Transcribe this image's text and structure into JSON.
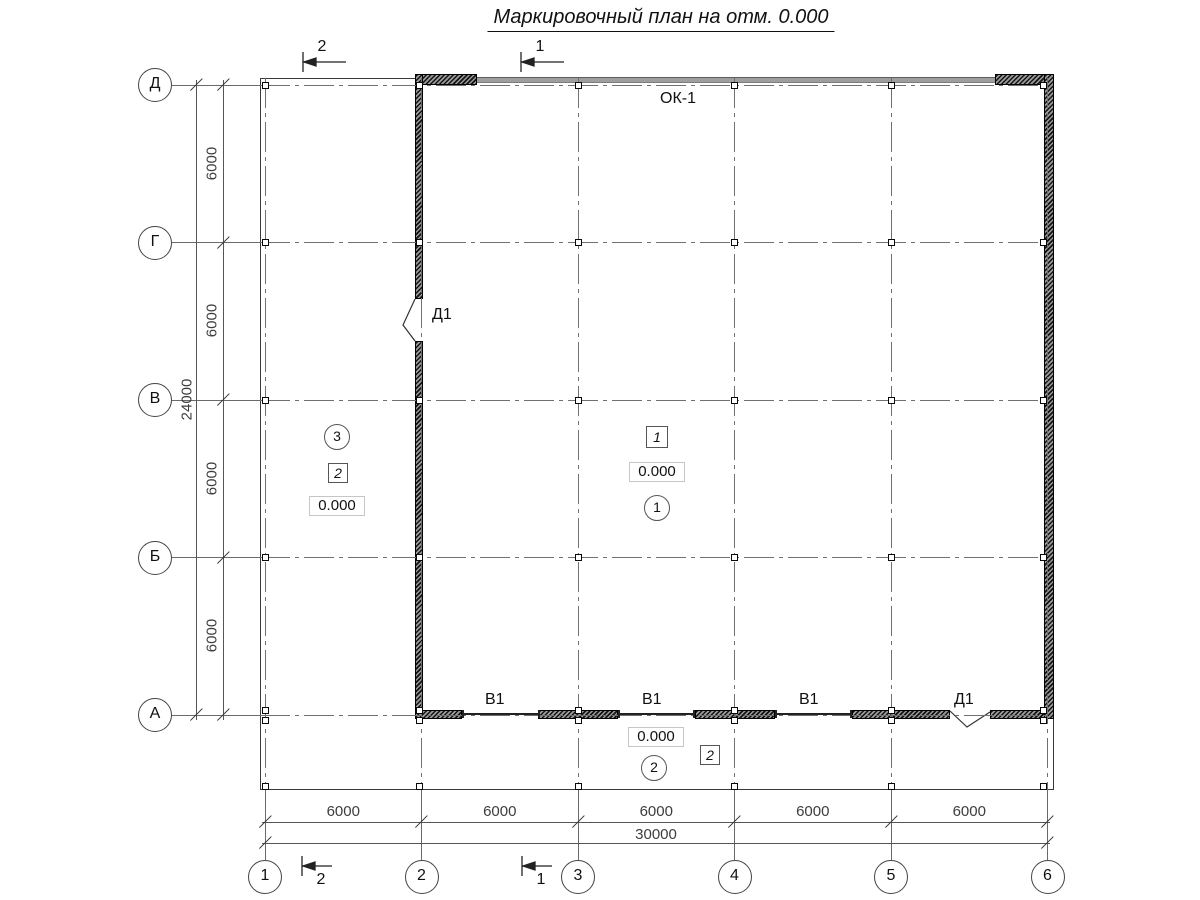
{
  "title": "Маркировочный план на отм. 0.000",
  "axes": {
    "rows": [
      "Д",
      "Г",
      "В",
      "Б",
      "А"
    ],
    "cols": [
      "1",
      "2",
      "3",
      "4",
      "5",
      "6"
    ]
  },
  "dims": {
    "row_segments": [
      "6000",
      "6000",
      "6000",
      "6000"
    ],
    "row_total": "24000",
    "col_segments": [
      "6000",
      "6000",
      "6000",
      "6000",
      "6000"
    ],
    "col_total": "30000"
  },
  "sections": {
    "top": [
      "2",
      "1"
    ],
    "bottom": [
      "2",
      "1"
    ]
  },
  "marks": {
    "window": "ОК-1",
    "door_left": "Д1",
    "door_bottom": "Д1",
    "gates": [
      "В1",
      "В1",
      "В1"
    ]
  },
  "rooms": {
    "hall": {
      "type_box": "1",
      "elevation": "0.000",
      "number": "1"
    },
    "bay": {
      "number": "3",
      "type_box": "2",
      "elevation": "0.000"
    },
    "strip": {
      "elevation": "0.000",
      "number": "2",
      "type_box": "2"
    }
  },
  "colors": {
    "line": "#333333",
    "grid": "#707070",
    "wall": "#141414",
    "window_band": "#9e9e9e",
    "dim_text": "#3d3d3d"
  }
}
